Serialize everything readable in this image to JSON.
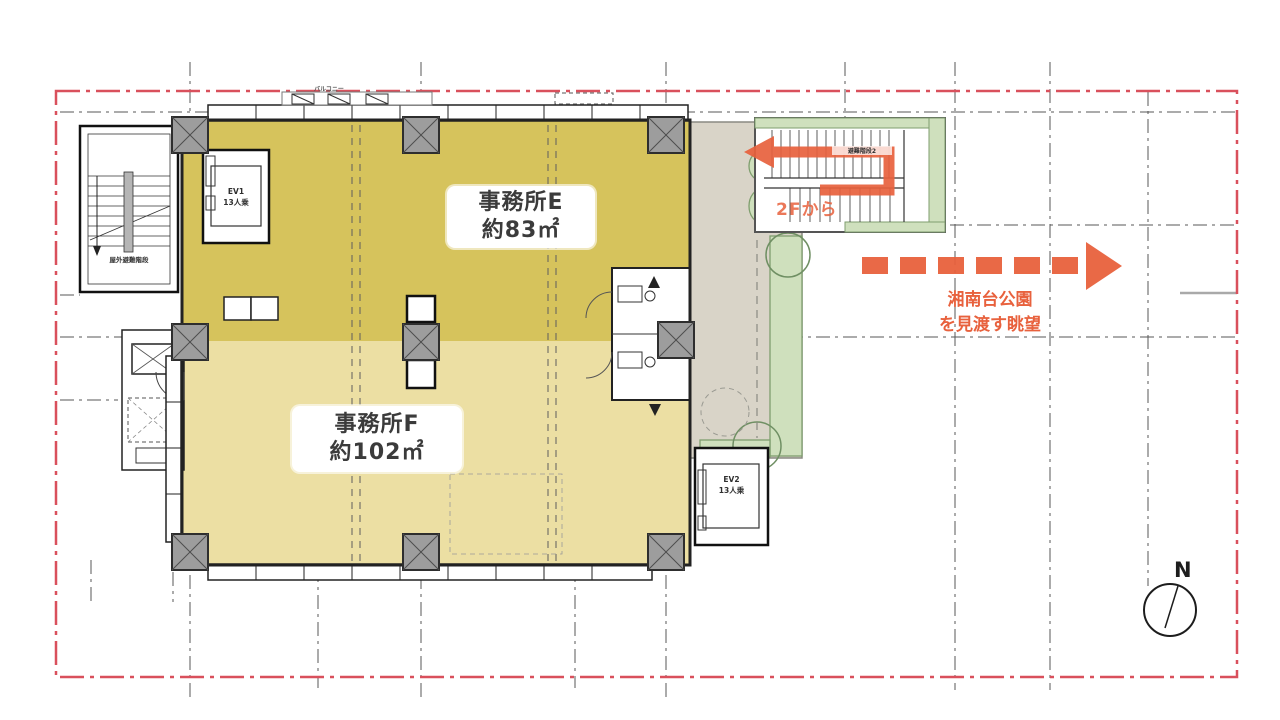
{
  "colors": {
    "office_e": "#d6c35c",
    "office_f": "#ecdfa3",
    "terrace": "#d9d4c8",
    "planting": "#cfe0bd",
    "planting_edge": "#7f9e6e",
    "column_fill": "#9d9d9d",
    "accent_orange": "#e8613d",
    "boundary_red": "#d9505c",
    "ink": "#2b2b2b"
  },
  "rooms": {
    "office_e": {
      "name": "事務所E",
      "area": "約83㎡"
    },
    "office_f": {
      "name": "事務所F",
      "area": "約102㎡"
    }
  },
  "elevators": {
    "ev1": {
      "label": "EV1",
      "capacity": "13人乗"
    },
    "ev2": {
      "label": "EV2",
      "capacity": "13人乗"
    }
  },
  "stairs": {
    "outdoor_escape": "屋外避難階段",
    "escape_2": "避難階段2"
  },
  "annotations": {
    "from_2f": "2Fから",
    "view_line1": "湘南台公園",
    "view_line2": "を見渡す眺望"
  },
  "balcony_label": "バルコニー",
  "compass": {
    "north": "N"
  }
}
